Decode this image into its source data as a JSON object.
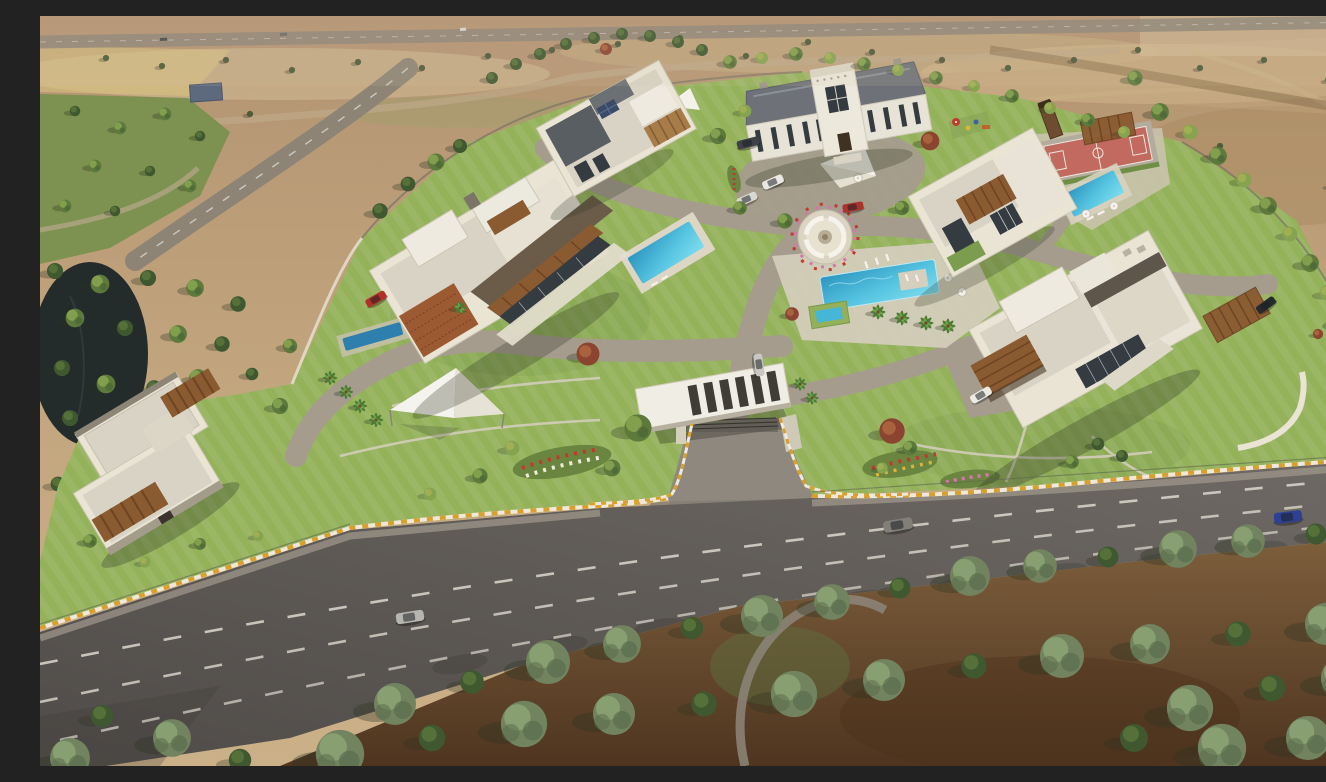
{
  "scene": {
    "type": "3d-aerial-architectural-rendering",
    "description": "Bird's-eye 3D rendering of a gated luxury villa compound with striped lawns, six villas, swimming pools, a sport court, a round lounge plaza, shade sails, an entrance gate with cantilevered canopy, internal driveways, a four-lane main road with cars, dense foreground trees on dirt ground, a pond and park to the west, and dry farmland with rural roads beyond"
  },
  "palette": {
    "field": "#c2a67e",
    "field_dark": "#a8895e",
    "field_light": "#d8c49c",
    "field_yellow": "#d9c27e",
    "park_grass": "#7d9150",
    "lawn": "#93b25a",
    "lawn_dark": "#69853f",
    "lawn_shadow": "#5d7a38",
    "asphalt": "#645f5b",
    "asphalt_dark": "#514d4a",
    "inner_road": "#a59c8e",
    "paver_light": "#d3ccba",
    "drive": "#8e887e",
    "curb_yellow": "#d9a02c",
    "curb_white": "#eee9dc",
    "lane_mark": "#ddd8cd",
    "wall_white": "#e9e4d4",
    "roof_gravel": "#d8d3c5",
    "roof_white": "#eeeae0",
    "roof_dark": "#5f564b",
    "roof_slate": "#6e7278",
    "parapet_dark": "#8d8575",
    "wood": "#8a5a30",
    "wood_dark": "#6e4423",
    "brick": "#9c5a33",
    "glass": "#343b41",
    "pool_water": "#45b6d8",
    "pool_deep": "#2d95bf",
    "pool_light": "#7edcee",
    "lap_pool": "#2e7fae",
    "pond": "#232b2b",
    "court_red": "#c26a60",
    "court_line": "#ece7dc",
    "tree_dark": "#3f5830",
    "tree_mid": "#5d7a3c",
    "tree_light": "#86a34f",
    "tree_yellow": "#a3af54",
    "tree_red": "#8a4430",
    "tree_sage": "#72845f",
    "tree_sage_dark": "#55674a",
    "dirt": "#7d5f3c",
    "dirt_dark": "#4f3520",
    "shadow": "#2c3322",
    "sail_white": "#f3f1ea",
    "flower_red": "#c03a2e",
    "flower_pink": "#d478a8",
    "flower_yellow": "#d9b43a"
  },
  "compound": {
    "villas": [
      {
        "name": "west-garden-villa",
        "style": "modern flat roof, gravel deck, timber pergola awnings"
      },
      {
        "name": "west-grand-villa",
        "style": "modern flat roof, brick screen wall, timber louvers, private pool, lap pool"
      },
      {
        "name": "north-villa",
        "style": "modern flat roof, roof deck, solar panel"
      },
      {
        "name": "classic-mansion",
        "style": "neoclassical, twin hipped slate roofs, paved forecourt"
      },
      {
        "name": "northeast-villa",
        "style": "modern flat roof, timber louver box, green roof, private pool, sport court, playground"
      },
      {
        "name": "east-grand-villa",
        "style": "modern flat roof, timber balcony, glass walls, lawn walkways, curved garden wall"
      }
    ],
    "amenities": [
      "central swimming pool with island deck",
      "spa pool",
      "round lounge fountain plaza",
      "sport court",
      "children playground",
      "white shade sails",
      "timber pergolas",
      "sun loungers and umbrellas",
      "flower beds"
    ],
    "entrance": {
      "name": "main-gate",
      "style": "cantilevered white canopy with skylight slots, security barrier, yellow-white striped curbs"
    }
  },
  "roads": {
    "main_road": {
      "lanes": 4,
      "markings": "white dashed lane lines",
      "edge": "yellow-white striped curb on compound wall"
    },
    "internal": "paved loop driveway linking all villas to the gate",
    "west_approach": "rural road with centre dashes",
    "north_highway": "distant highway strip"
  },
  "vehicles": [
    {
      "name": "red-sports-car-west-drive",
      "color": "#b23028"
    },
    {
      "name": "dark-sedan-mansion-forecourt",
      "color": "#3e4248"
    },
    {
      "name": "white-car-mansion-forecourt",
      "color": "#e9e8e3"
    },
    {
      "name": "white-car-2-mansion-forecourt",
      "color": "#d8d7d2"
    },
    {
      "name": "red-car-plaza",
      "color": "#ab332b"
    },
    {
      "name": "silver-car-inner-drive",
      "color": "#c9c7c2"
    },
    {
      "name": "white-sports-car-east-villa",
      "color": "#eceae2"
    },
    {
      "name": "black-car-northeast-road",
      "color": "#26292e"
    },
    {
      "name": "silver-car-main-road",
      "color": "#b7b5b0"
    },
    {
      "name": "grey-suv-main-road",
      "color": "#827e78"
    },
    {
      "name": "blue-car-main-road",
      "color": "#2e4094"
    }
  ],
  "vegetation": {
    "types": [
      "pine row",
      "round deciduous trees",
      "palms",
      "red maple accents",
      "sage-green foreground belt"
    ],
    "foreground": "dense tree belt over brown dirt with winding footpath"
  },
  "surroundings": {
    "north": "dry farmland, scattered trees, rural tracks, distant highway",
    "west": "green park with footpath and small building, vertical lane",
    "water": "dark pond behind west forest"
  }
}
